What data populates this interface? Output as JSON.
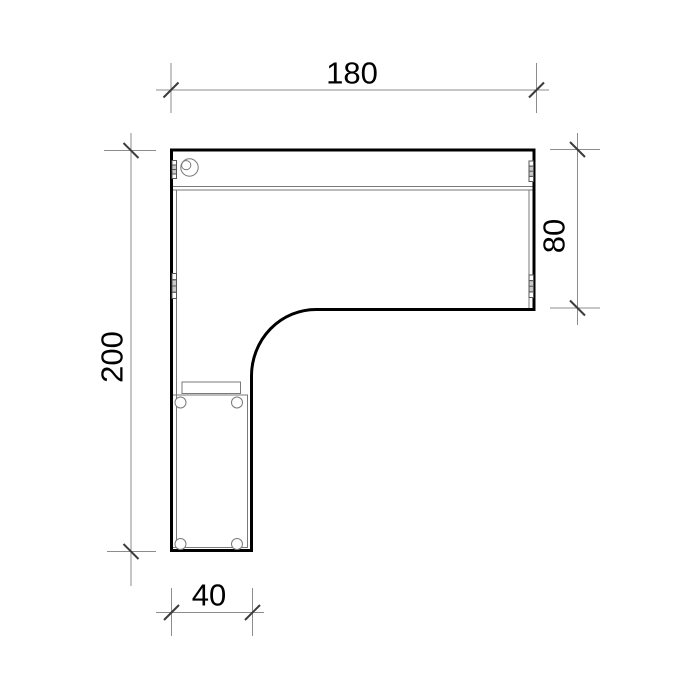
{
  "drawing": {
    "background": "#ffffff",
    "colors": {
      "outline": "#000000",
      "detail": "#7a7a7a",
      "fitting": "#555555",
      "fitting_fill": "#c9c9c9",
      "dim_line": "#8c8c8c",
      "tick": "#3c3c3c",
      "label": "#000000"
    },
    "labels": {
      "top_width": "180",
      "right_depth": "80",
      "left_depth": "200",
      "bottom_width": "40"
    },
    "features": [
      "cable-grommet",
      "connector-fitting",
      "caster-wheel",
      "drawer-pedestal"
    ]
  }
}
